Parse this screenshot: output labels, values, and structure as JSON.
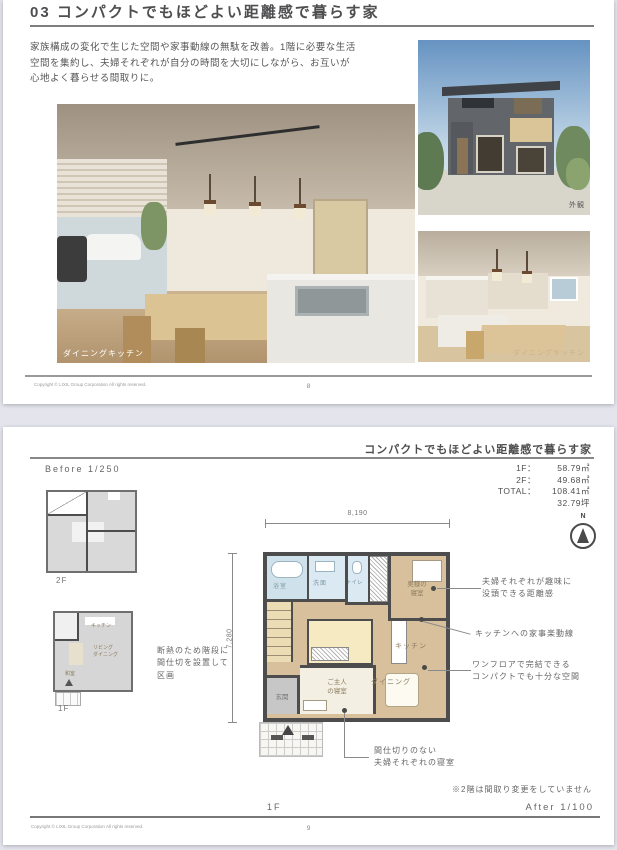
{
  "page1": {
    "title": "03 コンパクトでもほどよい距離感で暮らす家",
    "description": "家族構成の変化で生じた空間や家事動線の無駄を改善。1階に必要な生活\n空間を集約し、夫婦それぞれが自分の時間を大切にしながら、お互いが\n心地よく暮らせる間取りに。",
    "photos": {
      "main_label": "ダイニングキッチン",
      "exterior_label": "外観",
      "kitchen_label": "ダイニングキッチン"
    },
    "footer": {
      "copyright": "Copyright © LIXIL Group Corporation All rights reserved.",
      "page_number": "8"
    }
  },
  "page2": {
    "title": "コンパクトでもほどよい距離感で暮らす家",
    "area_table": {
      "rows": [
        {
          "label": "1F：",
          "value": "58.79㎡"
        },
        {
          "label": "2F：",
          "value": "49.68㎡"
        },
        {
          "label": "TOTAL：",
          "value": "108.41㎡"
        },
        {
          "label": "",
          "value": "32.79坪"
        }
      ]
    },
    "before": {
      "label": "Before 1/250",
      "floor2_label": "2F",
      "floor1_label": "1F",
      "rooms_1f": {
        "kitchen": "キッチン",
        "living": "リビング\nダイニング",
        "washitsu": "和室"
      }
    },
    "after": {
      "label": "After 1/100",
      "floor_label": "1F",
      "compass_label": "N",
      "dim_width": "8,190",
      "dim_height": "7,280",
      "rooms": {
        "bath": "浴室",
        "wash": "洗面",
        "toilet": "トイレ",
        "wife": "奥様の\n寝室",
        "kitchen": "キッチン",
        "dining": "ダイニング",
        "entrance": "玄関",
        "husband": "ご主人\nの寝室"
      }
    },
    "annotations": {
      "insulation": "断熱のため階段に\n間仕切を設置して\n区画",
      "hobby": "夫婦それぞれが趣味に\n没頭できる距離感",
      "kitchen_flow": "キッチンへの家事楽動線",
      "one_floor": "ワンフロアで完結できる\nコンパクトでも十分な空間",
      "no_partition": "間仕切りのない\n夫婦それぞれの寝室",
      "note": "※2階は間取り変更をしていません"
    },
    "footer": {
      "copyright": "Copyright © LIXIL Group Corporation All rights reserved.",
      "page_number": "9"
    }
  }
}
